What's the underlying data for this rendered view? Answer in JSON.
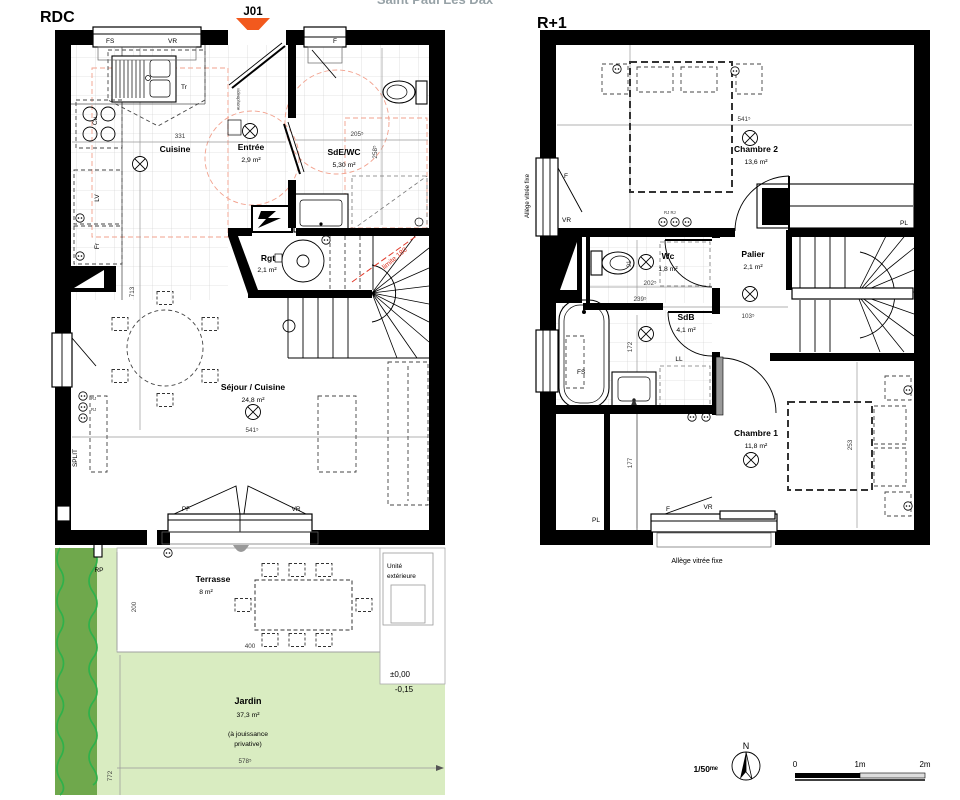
{
  "meta": {
    "project_partial": "Saint Paul Les Dax"
  },
  "rdc": {
    "title": "RDC",
    "unit_marker": "J01",
    "rooms": {
      "cuisine": {
        "name": "Cuisine"
      },
      "entree": {
        "name": "Entrée",
        "area": "2,9 m²"
      },
      "sde": {
        "name": "SdE/WC",
        "area": "5,30 m²"
      },
      "rgt": {
        "name": "Rgt",
        "area": "2,1 m²"
      },
      "sejour": {
        "name": "Séjour / Cuisine",
        "area": "24,8 m²"
      }
    },
    "labels": {
      "fs": "FS",
      "vr_top": "VR",
      "f_top": "F",
      "tr": "Tr",
      "videophone": "videophone",
      "cu": "Cu",
      "lv": "LV",
      "fr": "Fr",
      "split": "SPLIT",
      "rj_a": "RJ",
      "rj_b": "RJ",
      "pf": "PF",
      "vr_bottom": "VR",
      "rp": "RP",
      "limite": "limite 180"
    },
    "dims": {
      "d331": "331",
      "d205": "205⁵",
      "d258": "258⁵",
      "d713": "713",
      "d541": "541⁵"
    }
  },
  "outdoor": {
    "terrasse": {
      "name": "Terrasse",
      "area": "8 m²"
    },
    "jardin": {
      "name": "Jardin",
      "area": "37,3 m²",
      "note_line1": "(à jouissance",
      "note_line2": "privative)"
    },
    "unite": {
      "line1": "Unité",
      "line2": "extérieure"
    },
    "levels": {
      "terrace": "±0,00",
      "garden": "-0,15"
    },
    "dims": {
      "d200": "200",
      "d400": "400",
      "d578": "578⁵",
      "d772": "772"
    }
  },
  "r1": {
    "title": "R+1",
    "rooms": {
      "chambre2": {
        "name": "Chambre 2",
        "area": "13,6 m²"
      },
      "wc": {
        "name": "Wc",
        "area": "1,8 m²"
      },
      "palier": {
        "name": "Palier",
        "area": "2,1 m²"
      },
      "sdb": {
        "name": "SdB",
        "area": "4,1 m²"
      },
      "chambre1": {
        "name": "Chambre 1",
        "area": "11,8 m²"
      }
    },
    "labels": {
      "allege_left": "Allège vitrée fixe",
      "allege_bottom": "Allège vitrée fixe",
      "f_ch2": "F",
      "vr_ch2": "VR",
      "f_ch1": "F",
      "vr_ch1": "VR",
      "pl_right": "PL",
      "pl_under_stairs": "PL",
      "fs": "FS",
      "ll": "LL",
      "rj": "RJ RJ"
    },
    "dims": {
      "d541": "541⁵",
      "d91": "91",
      "d202": "202⁵",
      "d239": "239⁵",
      "d103": "103⁵",
      "d172": "172",
      "d177": "177",
      "d253": "253"
    }
  },
  "footer": {
    "scale": "1/50ᵐᵉ",
    "north": "N",
    "bar0": "0",
    "bar1": "1m",
    "bar2": "2m"
  },
  "colors": {
    "wall": "#000000",
    "marker_orange": "#f2591d",
    "garden": "#d9ecc1",
    "hedge": "#6fa84c",
    "hedge_line": "#2fb14a",
    "limit_red": "#e03a2a",
    "access_salmon": "#f2a08c"
  }
}
